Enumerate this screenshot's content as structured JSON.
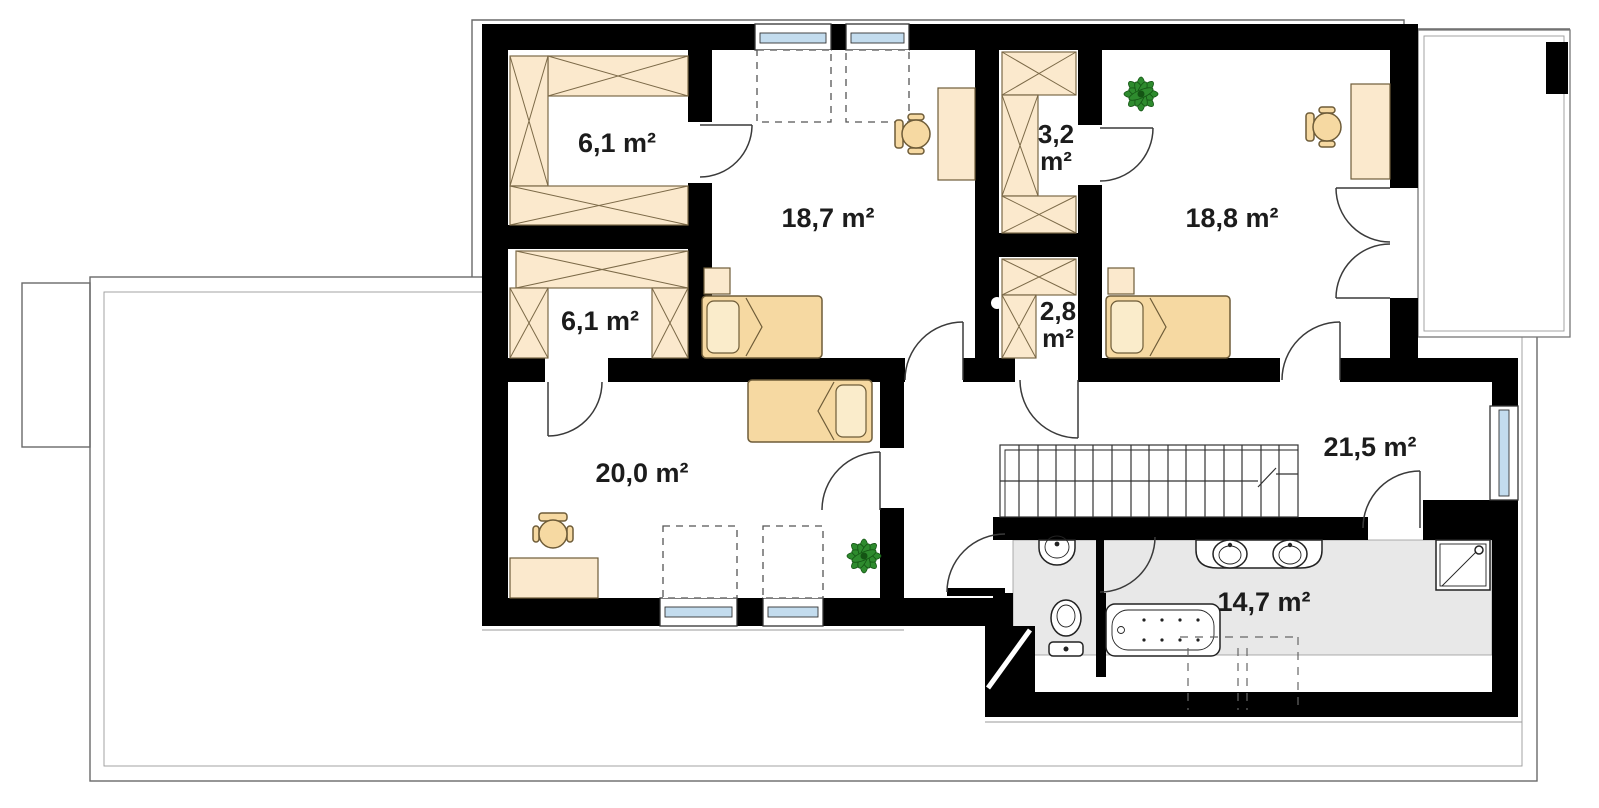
{
  "plan": {
    "rooms": {
      "closet_top_left": {
        "label": "6,1 m²"
      },
      "bedroom_top": {
        "label": "18,7 m²"
      },
      "closet_3_2": {
        "line1": "3,2",
        "line2": "m²"
      },
      "bedroom_right": {
        "label": "18,8 m²"
      },
      "closet_bottom_left": {
        "label": "6,1 m²"
      },
      "closet_2_8": {
        "line1": "2,8",
        "line2": "m²"
      },
      "bedroom_left": {
        "label": "20,0 m²"
      },
      "hall": {
        "label": "21,5 m²"
      },
      "bathroom": {
        "label": "14,7 m²"
      }
    },
    "colors": {
      "wall": "#000000",
      "wardrobe_fill": "#fbe9cd",
      "bed_fill": "#f6d9a2",
      "bath_floor": "#e8e8e8",
      "window_glass": "#c3dcee",
      "plant_green": "#2e8b2e",
      "label_text": "#1c1c1c",
      "outline_gray": "#6a6a6a"
    }
  }
}
